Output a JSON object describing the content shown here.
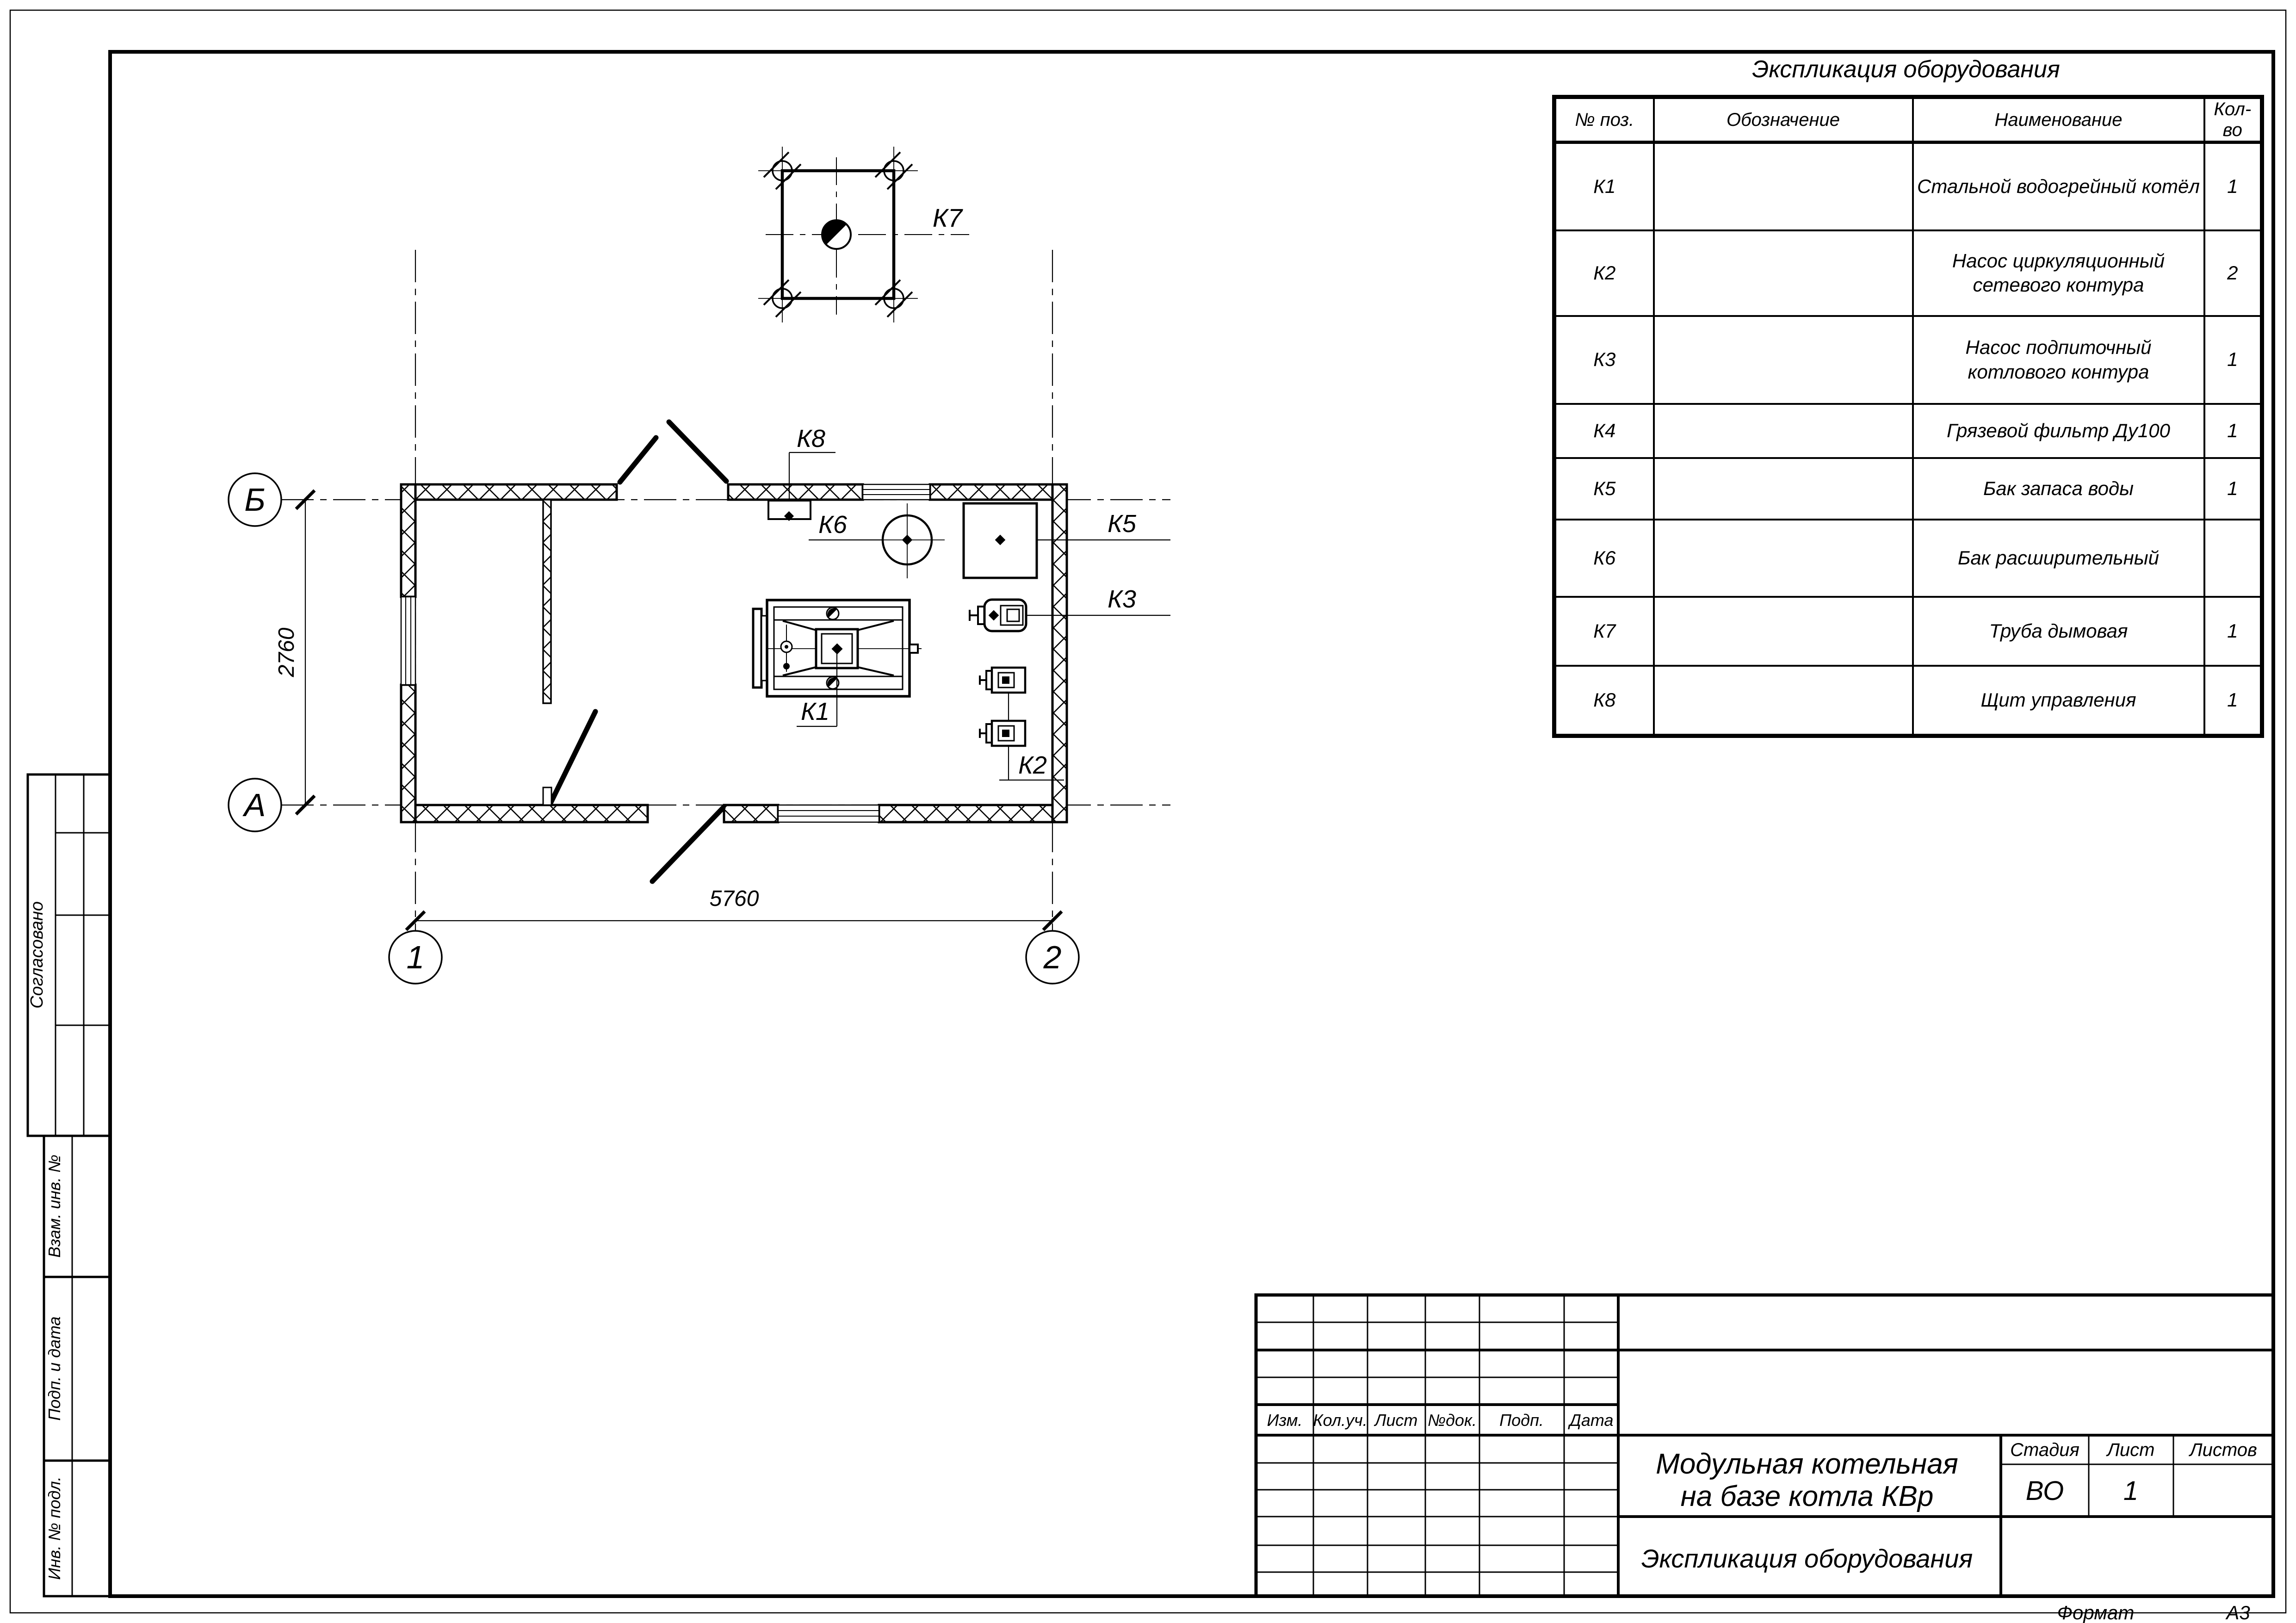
{
  "equipment_table": {
    "title": "Экспликация оборудования",
    "columns": [
      "№ поз.",
      "Обозначение",
      "Наименование",
      "Кол-во"
    ],
    "rows": [
      {
        "pos": "К1",
        "designation": "",
        "name": "Стальной водогрейный котёл",
        "qty": "1"
      },
      {
        "pos": "К2",
        "designation": "",
        "name": "Насос циркуляционный сетевого контура",
        "qty": "2"
      },
      {
        "pos": "К3",
        "designation": "",
        "name": "Насос подпиточный котлового контура",
        "qty": "1"
      },
      {
        "pos": "К4",
        "designation": "",
        "name": "Грязевой фильтр Ду100",
        "qty": "1"
      },
      {
        "pos": "К5",
        "designation": "",
        "name": "Бак запаса воды",
        "qty": "1"
      },
      {
        "pos": "К6",
        "designation": "",
        "name": "Бак расширительный",
        "qty": ""
      },
      {
        "pos": "К7",
        "designation": "",
        "name": "Труба дымовая",
        "qty": "1"
      },
      {
        "pos": "К8",
        "designation": "",
        "name": "Щит управления",
        "qty": "1"
      }
    ]
  },
  "plan": {
    "axes": {
      "row_top": "Б",
      "row_bottom": "А",
      "col_left": "1",
      "col_right": "2"
    },
    "dims": {
      "horizontal": "5760",
      "vertical": "2760"
    },
    "tags": {
      "k1": "К1",
      "k2": "К2",
      "k3": "К3",
      "k5": "К5",
      "k6": "К6",
      "k7": "К7",
      "k8": "К8"
    }
  },
  "title_block": {
    "revision_headers": [
      "Изм.",
      "Кол.уч.",
      "Лист",
      "№док.",
      "Подп.",
      "Дата"
    ],
    "project_title_line1": "Модульная котельная",
    "project_title_line2": "на базе котла КВр",
    "stage_label": "Стадия",
    "sheet_label": "Лист",
    "sheets_label": "Листов",
    "stage_value": "ВО",
    "sheet_value": "1",
    "sheets_value": "",
    "doc_title": "Экспликация оборудования",
    "format_label": "Формат",
    "format_value": "А3"
  },
  "side_stamp": {
    "agreed": "Согласовано",
    "replace_inv": "Взам. инв. №",
    "sign_date": "Подп. и дата",
    "inv_orig": "Инв. № подл."
  }
}
